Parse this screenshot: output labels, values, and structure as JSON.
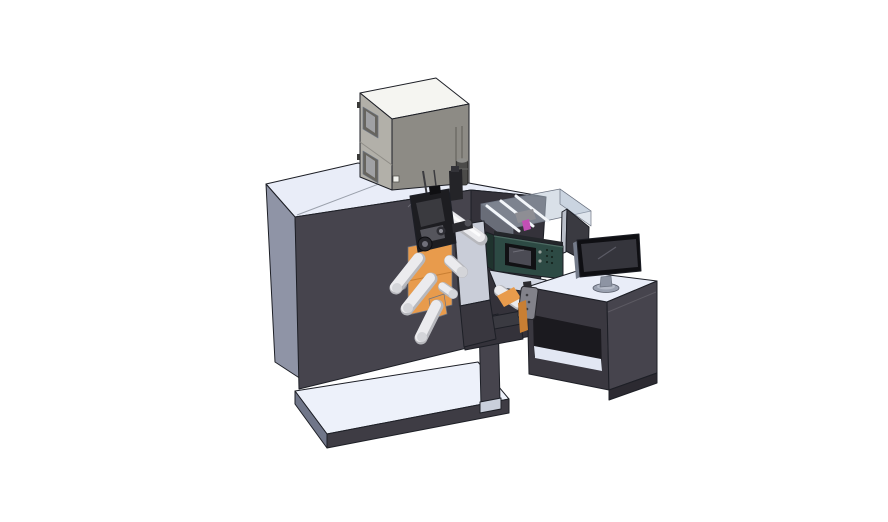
{
  "scene": {
    "canvas": {
      "width": 888,
      "height": 522
    },
    "background": "#ffffff",
    "colors": {
      "outline": "#1d1f26",
      "cabinet_top": "#e9edf8",
      "cabinet_side": "#8f94a6",
      "cabinet_front": "#46444d",
      "cabinet_recess": "#34323a",
      "platform_top": "#edf1fa",
      "platform_skirt": "#3e3c44",
      "platform_side": "#707689",
      "dryer_top": "#f5f5f1",
      "dryer_side": "#b2b0a9",
      "dryer_front": "#8d8b85",
      "dryer_detail": "#67655f",
      "dryer_window_glass": "#a0a1a4",
      "canister": "#4b4b49",
      "canister_cap": "#8e8e8a",
      "roller_light": "#ebebee",
      "roller_shadow": "#b7b8bd",
      "roller_cap": "#d4d5d9",
      "orange": "#e89b4c",
      "orange_dark": "#c97f33",
      "teal": "#2d4a44",
      "teal_dark": "#1f332e",
      "display_bezel": "#111114",
      "display_screen": "#4b4b54",
      "glass": "#b9c6d6",
      "rail_light": "#f3f6fa",
      "pink": "#c24fb5",
      "panel_dark": "#3a3a41",
      "panel_edge": "#b9bec8",
      "monitor_bezel": "#0f0f13",
      "monitor_screen": "#35353c",
      "monitor_edge": "#747b8a",
      "stand_gray": "#9aa1b0",
      "stand_top": "#b4bac7",
      "pendant_gray": "#82828a",
      "plate_light": "#c9cdd8",
      "plate_lower": "#39373f",
      "mech_black": "#1d1d21",
      "mech_gray": "#3a3a3f",
      "mech_light": "#55555c",
      "desk_left": "#3a3840",
      "desk_interior": "#1b1a1f",
      "shelf_floor": "#e2e7f3",
      "desk_base": "#2c2a31",
      "leg_foot": "#c9cfdb",
      "tray_light": "#dde3ee",
      "seam": "#9aa0ab",
      "hole_gray": "#858a96",
      "module_edge_dark": "#23262a"
    },
    "components": [
      "main-enclosure",
      "dryer-cabinet",
      "exhaust-canister",
      "print-mechanism",
      "unwind-roller-assembly",
      "media-web",
      "divider-plate",
      "inkjet-module-guard",
      "hmi-unit",
      "rear-display-panel",
      "operator-pendant",
      "transfer-bridge",
      "control-desk",
      "desktop-monitor",
      "base-platform",
      "machine-leg"
    ]
  }
}
